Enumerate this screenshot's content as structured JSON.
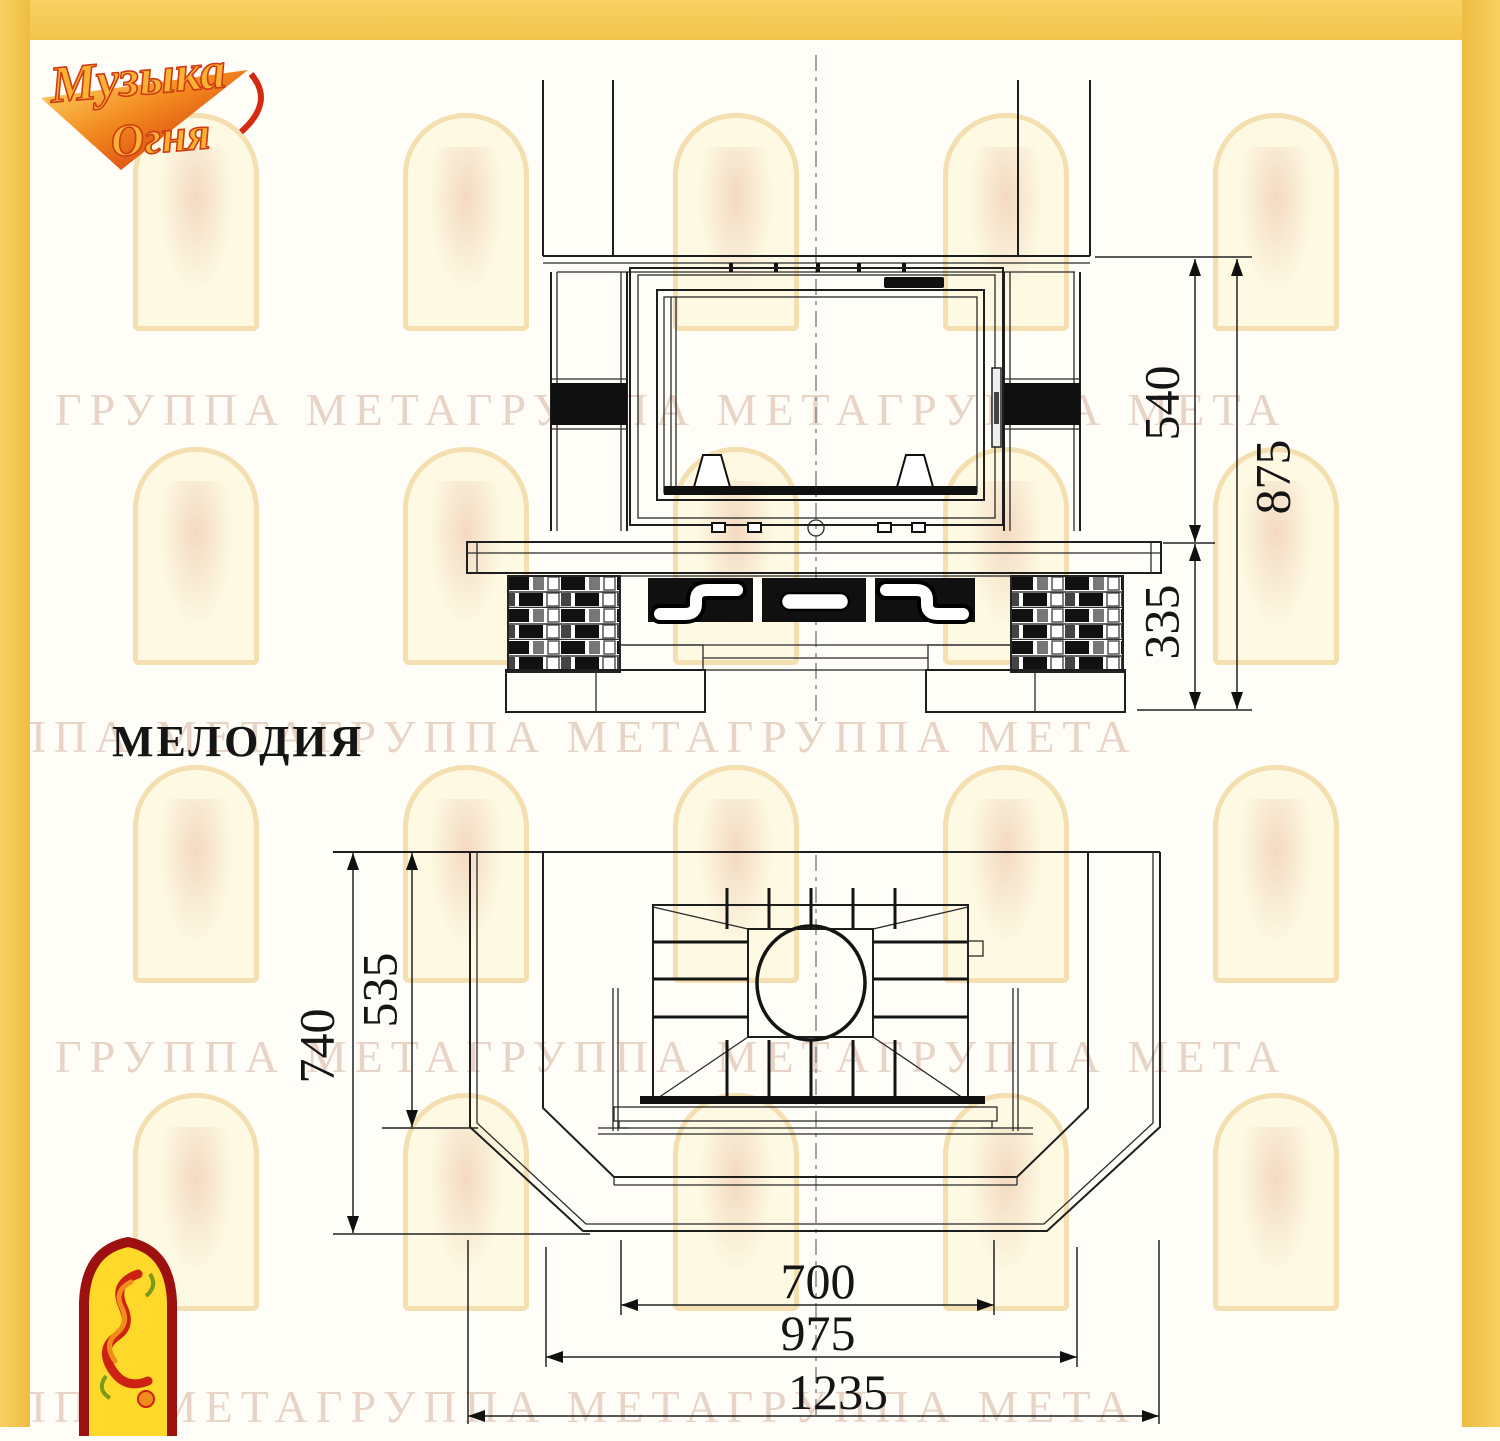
{
  "logo": {
    "line1": "Музыка",
    "line2": "Огня"
  },
  "title": "МЕЛОДИЯ",
  "watermark": {
    "text": "ГРУППА МЕТАГРУППА МЕТАГРУППА МЕТА"
  },
  "front_view": {
    "dims": {
      "d540": "540",
      "d875": "875",
      "d335": "335"
    }
  },
  "plan_view": {
    "dims": {
      "d740": "740",
      "d535": "535",
      "d700": "700",
      "d975": "975",
      "d1235": "1235"
    }
  },
  "drawing": {
    "model": "МЕЛОДИЯ",
    "front_dimensions_mm": {
      "firebox_zone_height": 540,
      "base_height": 335,
      "total_height": 875
    },
    "plan_dimensions_mm": {
      "depth": 740,
      "inner_depth": 535,
      "hearth_front_width": 700,
      "inner_width": 975,
      "overall_width": 1235
    }
  }
}
